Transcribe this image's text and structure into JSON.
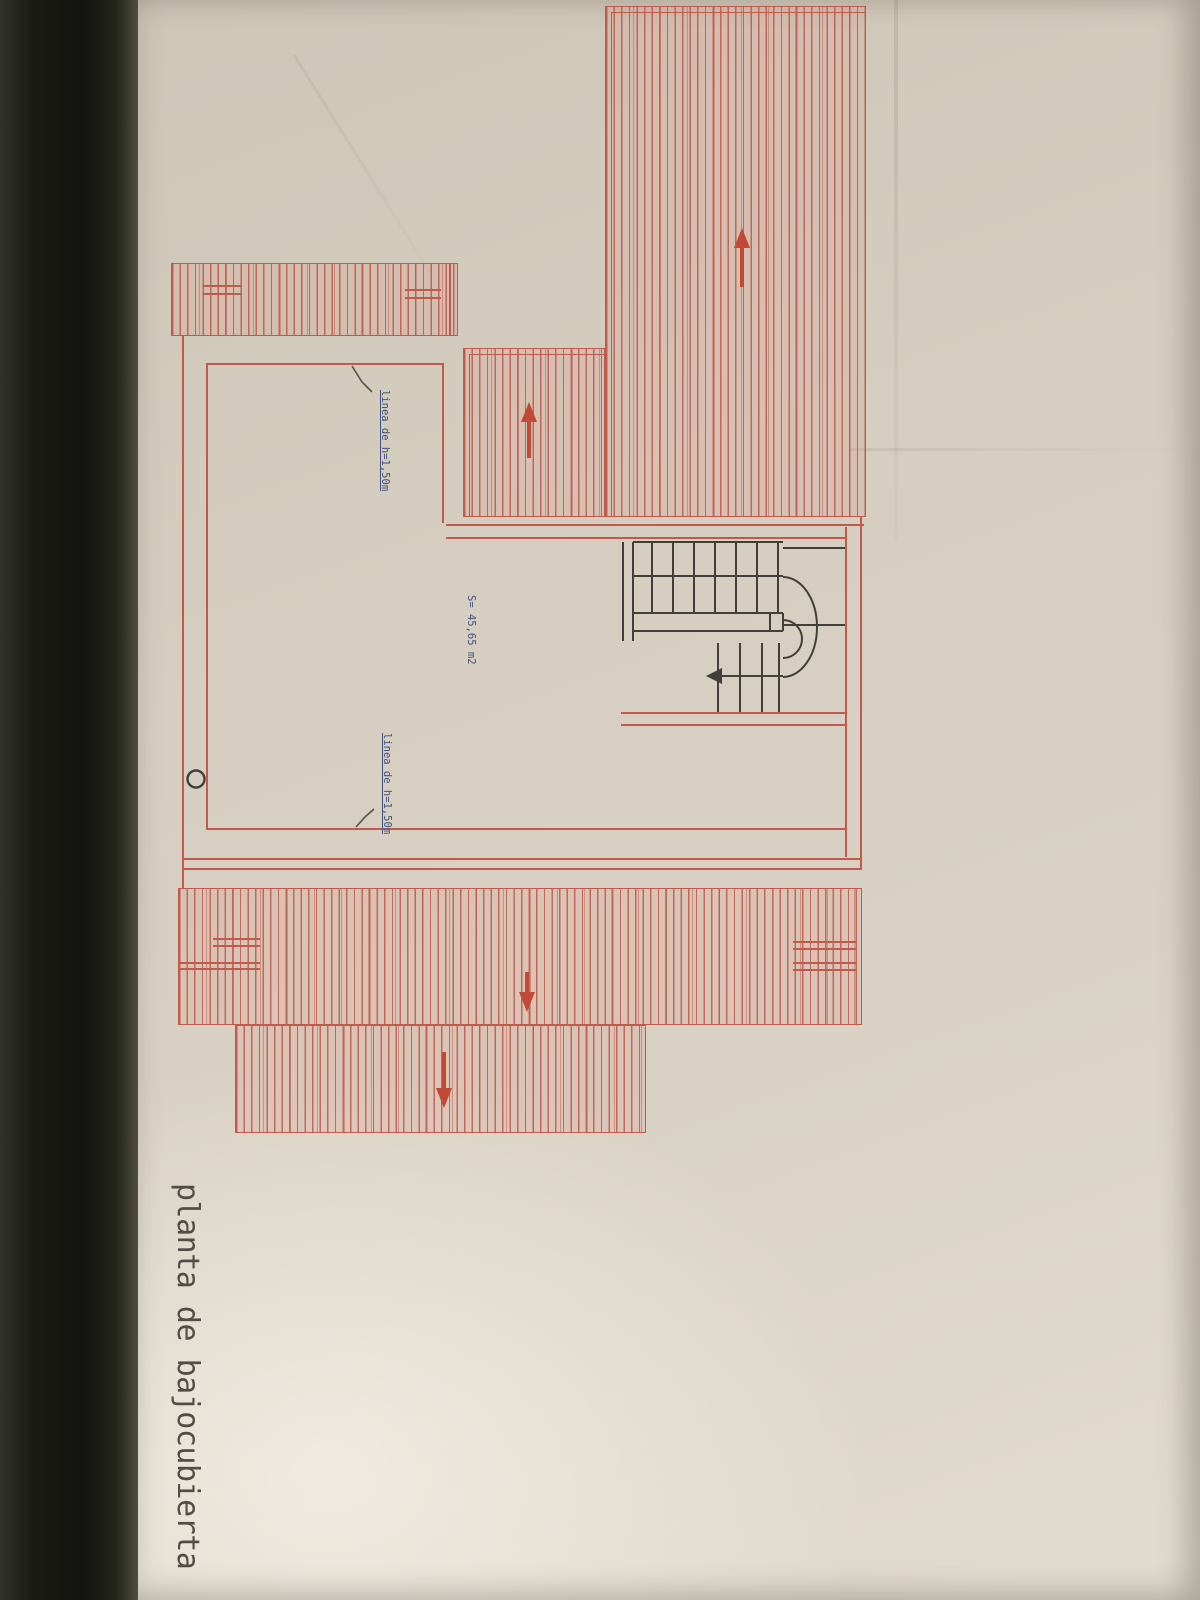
{
  "title": {
    "text": "planta de bajocubierta"
  },
  "annotations": {
    "height_line_top": {
      "label": "linea de h=1,50m"
    },
    "height_line_bottom": {
      "label": "linea de h=1,50m"
    },
    "area": {
      "label": "S= 45,65 m2"
    }
  },
  "plan": {
    "type": "attic (bajocubierta) floor plan, hand-drafted, photographed rotated 90deg",
    "roof_areas": [
      {
        "name": "large-roof-slope-right",
        "hatch": "parallel lines",
        "slope_arrow": "up"
      },
      {
        "name": "middle-roof-slope",
        "hatch": "parallel lines",
        "slope_arrow": "up"
      },
      {
        "name": "upper-left-eave-band",
        "hatch": "parallel lines",
        "slope_arrow": null
      },
      {
        "name": "lower-roof-band",
        "hatch": "parallel lines",
        "slope_arrow": "down"
      },
      {
        "name": "lowest-roof-band",
        "hatch": "parallel lines",
        "slope_arrow": "down"
      }
    ],
    "stair": {
      "type": "U-shaped stair with half-turn",
      "walk_arrow": "left"
    },
    "symbols": [
      "small-circle-column"
    ]
  },
  "colors": {
    "plan_red": "#bf5a4c",
    "arrow_red": "#c24936",
    "annotation_blue": "#41517e",
    "ink_black": "#413f3a",
    "leader_gray": "#55544c",
    "paper": "#d6cec0",
    "dark_edge": "#17170f",
    "title_ink": "#4f4d45"
  }
}
